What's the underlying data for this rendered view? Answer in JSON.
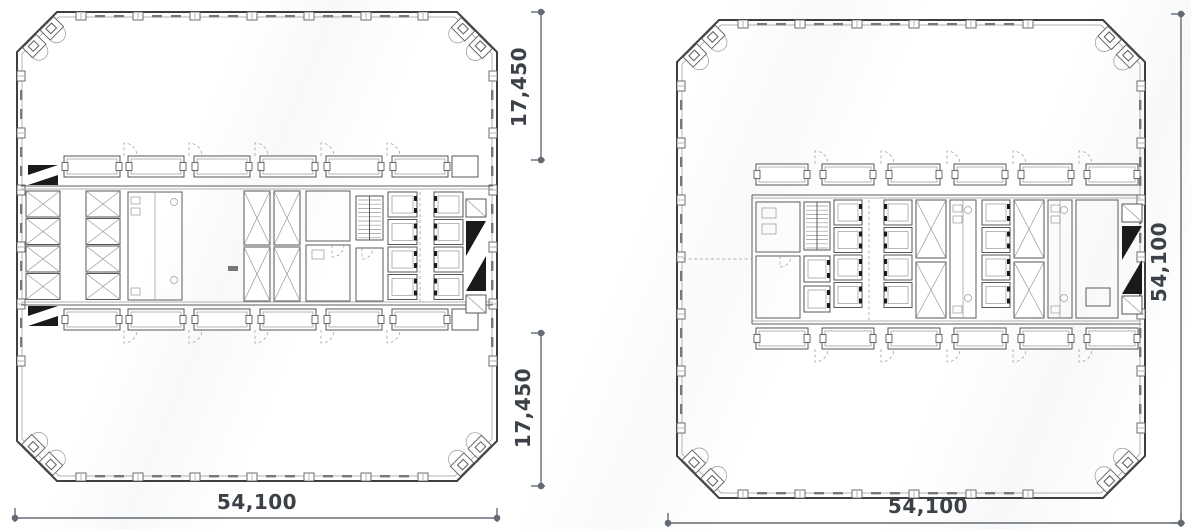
{
  "dimensions": {
    "left_plan": {
      "right_top": "17,450",
      "right_bottom": "17,450",
      "bottom": "54,100"
    },
    "right_plan": {
      "right": "54,100",
      "bottom": "54,100"
    }
  },
  "colors": {
    "ink": "#3c4148",
    "wall_line": "#3f3f3f",
    "thin_line": "#979797",
    "dimension_line": "#646b73",
    "poche_fill": "#1a1a1a",
    "background": "#ffffff"
  }
}
